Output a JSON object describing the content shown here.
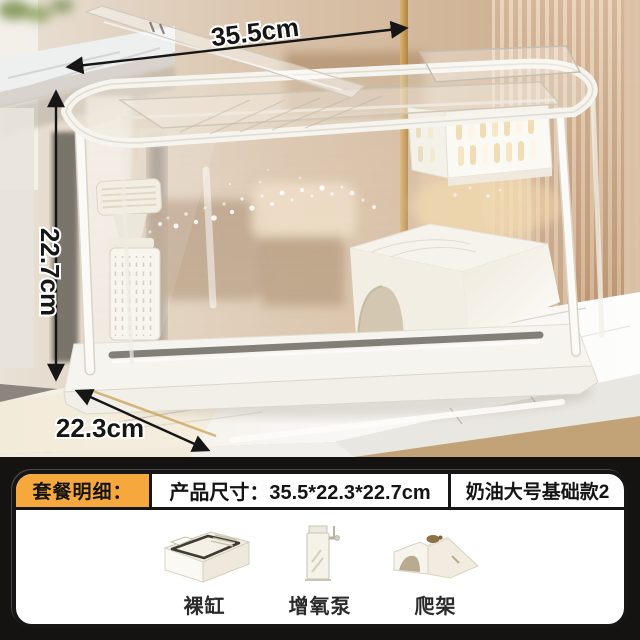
{
  "photo": {
    "annotations": {
      "width_label": "35.5cm",
      "height_label": "22.7cm",
      "depth_label": "22.3cm"
    }
  },
  "panel": {
    "accent_color": "#F7A83C",
    "header": {
      "package_label": "套餐明细：",
      "size_label": "产品尺寸：35.5*22.3*22.7cm",
      "variant_label": "奶油大号基础款2"
    },
    "items": [
      {
        "id": "bare-tank",
        "label": "裸缸"
      },
      {
        "id": "oxygen-pump",
        "label": "增氧泵"
      },
      {
        "id": "climbing-ramp",
        "label": "爬架"
      }
    ]
  },
  "colors": {
    "panel_background": "#151312",
    "accent": "#F7A83C",
    "annotation_ink": "#161616",
    "wood_slats": "#C79E7A",
    "marble": "#F6F5F1"
  }
}
